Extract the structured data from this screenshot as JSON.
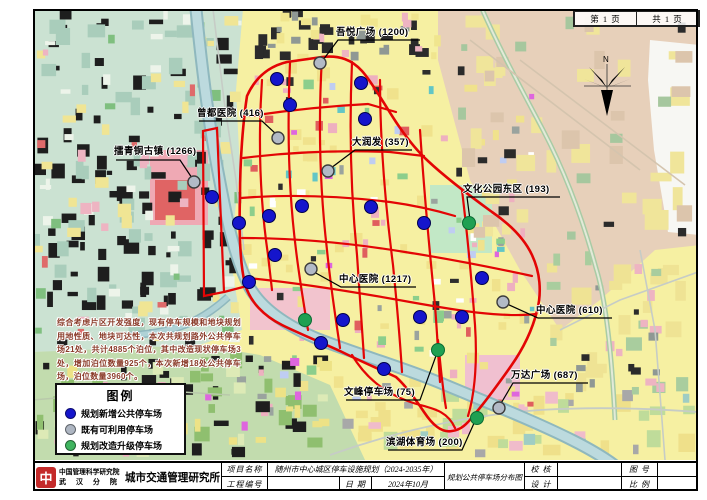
{
  "sheet": {
    "page_no": "第 1 页",
    "page_total": "共 1 页"
  },
  "compass": {
    "label": "N"
  },
  "note": {
    "text": "综合考虑片区开发强度，现有停车规模和地块规划用地性质、地块可达性，本次共规划路外公共停车场21处，共计4885个泊位，其中改造现状停车场3处，增加泊位数量925个，本次新增18处公共停车场，泊位数量3960个。",
    "color": "#8a3a28"
  },
  "legend": {
    "title": "图例",
    "items": [
      {
        "key": "new",
        "label": "规划新增公共停车场",
        "color": "#1515cc"
      },
      {
        "key": "existing",
        "label": "既有可利用停车场",
        "color": "#aeb6c2"
      },
      {
        "key": "upgrade",
        "label": "规划改造升级停车场",
        "color": "#3fb45f"
      }
    ]
  },
  "parking": {
    "dot_colors": {
      "new": {
        "fill": "#1515cc",
        "stroke": "#00004d"
      },
      "existing": {
        "fill": "#b2bac6",
        "stroke": "#3c3c3c"
      },
      "upgrade": {
        "fill": "#1fa052",
        "stroke": "#0b6b33"
      }
    },
    "new": [
      [
        277,
        79
      ],
      [
        361,
        83
      ],
      [
        290,
        105
      ],
      [
        365,
        119
      ],
      [
        212,
        197
      ],
      [
        302,
        206
      ],
      [
        269,
        216
      ],
      [
        239,
        223
      ],
      [
        371,
        207
      ],
      [
        424,
        223
      ],
      [
        275,
        255
      ],
      [
        249,
        282
      ],
      [
        482,
        278
      ],
      [
        420,
        317
      ],
      [
        462,
        317
      ],
      [
        343,
        320
      ],
      [
        321,
        343
      ],
      [
        384,
        369
      ]
    ],
    "existing": [
      [
        320,
        63
      ],
      [
        278,
        138
      ],
      [
        194,
        182
      ],
      [
        328,
        171
      ],
      [
        311,
        269
      ],
      [
        503,
        302
      ],
      [
        499,
        408
      ]
    ],
    "upgrade": [
      [
        469,
        223
      ],
      [
        305,
        320
      ],
      [
        438,
        350
      ],
      [
        477,
        418
      ]
    ]
  },
  "callouts": [
    {
      "text": "擂青铜古镇 (1266)",
      "tx": 114,
      "ty": 143,
      "line": [
        [
          116,
          160
        ],
        [
          180,
          160
        ],
        [
          192,
          178
        ]
      ]
    },
    {
      "text": "曾都医院 (416)",
      "tx": 197,
      "ty": 105,
      "line": [
        [
          199,
          121
        ],
        [
          262,
          121
        ],
        [
          276,
          134
        ]
      ]
    },
    {
      "text": "吾悦广场 (1200)",
      "tx": 336,
      "ty": 24,
      "line": [
        [
          420,
          40
        ],
        [
          338,
          40
        ],
        [
          323,
          60
        ]
      ]
    },
    {
      "text": "大润发 (357)",
      "tx": 352,
      "ty": 134,
      "line": [
        [
          412,
          150
        ],
        [
          355,
          150
        ],
        [
          331,
          168
        ]
      ]
    },
    {
      "text": "文化公园东区 (193)",
      "tx": 463,
      "ty": 181,
      "line": [
        [
          560,
          197
        ],
        [
          467,
          197
        ],
        [
          470,
          220
        ]
      ]
    },
    {
      "text": "中心医院 (1217)",
      "tx": 339,
      "ty": 271,
      "line": [
        [
          416,
          287
        ],
        [
          341,
          287
        ],
        [
          314,
          272
        ]
      ]
    },
    {
      "text": "中心医院 (610)",
      "tx": 536,
      "ty": 302,
      "line": [
        [
          612,
          318
        ],
        [
          538,
          318
        ],
        [
          507,
          304
        ]
      ]
    },
    {
      "text": "万达广场 (687)",
      "tx": 511,
      "ty": 367,
      "line": [
        [
          588,
          383
        ],
        [
          513,
          383
        ],
        [
          500,
          405
        ]
      ]
    },
    {
      "text": "文峰停车场 (75)",
      "tx": 344,
      "ty": 384,
      "line": [
        [
          346,
          400
        ],
        [
          420,
          400
        ],
        [
          437,
          353
        ]
      ]
    },
    {
      "text": "滨湖体育场 (200)",
      "tx": 386,
      "ty": 434,
      "line": [
        [
          388,
          450
        ],
        [
          462,
          450
        ],
        [
          475,
          421
        ]
      ]
    }
  ],
  "titleblock": {
    "org_line1": "中国管理科学研究院",
    "org_line2": "武 汉 分 院",
    "org_logo_glyph": "中",
    "org_name": "城市交通管理研究所",
    "project_label": "项目名称",
    "project_value": "随州市中心城区停车设施规划（2024-2035年）",
    "code_label": "工程编号",
    "date_label": "日  期",
    "date_value": "2024年10月",
    "drawing_title": "规划公共停车场分布图",
    "check_label": "校  核",
    "design_label": "设  计",
    "figno_label": "图  号",
    "scale_label": "比  例"
  }
}
